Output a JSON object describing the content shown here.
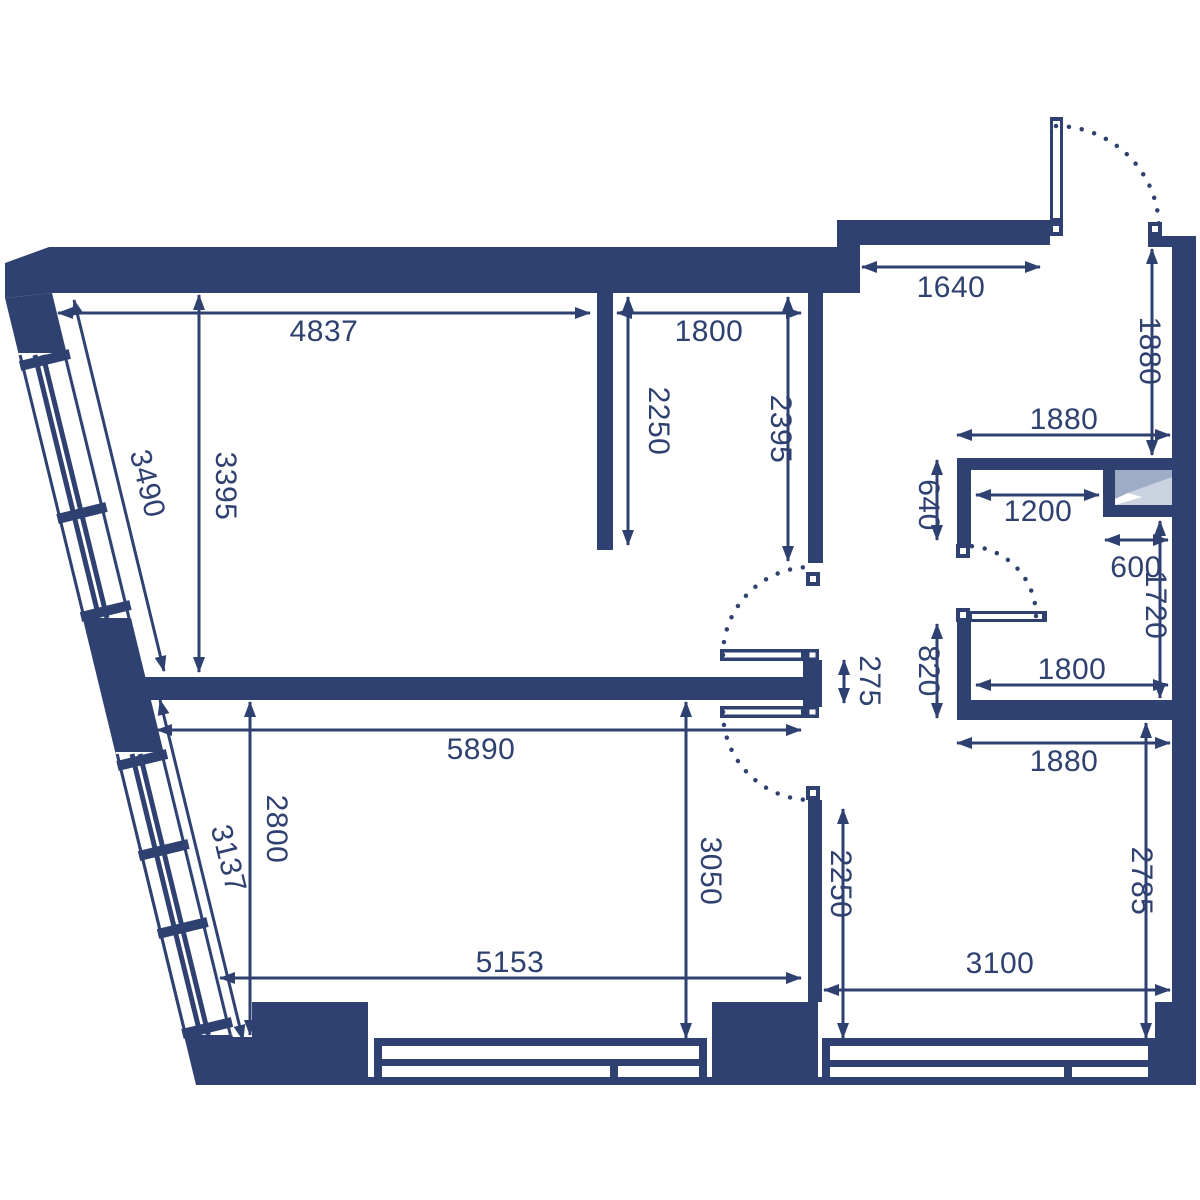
{
  "title": "Apartment floor plan",
  "colors": {
    "wall": "#2f4170",
    "background": "#ffffff",
    "shaft_light": "#cbd3e1",
    "shaft_dark": "#9facc6"
  },
  "dims": {
    "living_room_width": "4837",
    "upper_mid_room_width": "1800",
    "left_partition_length": "2250",
    "right_partition_length": "2395",
    "entry_wall_width": "1640",
    "entry_side_height": "1880",
    "bath_outer_width": "1880",
    "bath_wall_upper": "640",
    "bath_inner_top_width": "1200",
    "shaft_width": "600",
    "bath_inner_right_height": "1720",
    "bath_wall_lower": "820",
    "bath_inner_bottom_width": "1800",
    "below_bath_width": "1880",
    "kitchen_right_height": "2785",
    "kitchen_width": "3100",
    "kitchen_left_height": "2250",
    "lower_room_mid_height": "3050",
    "lower_room_left_height": "2800",
    "hall_span_width": "5890",
    "bay_window_upper_length": "3490",
    "living_room_height": "3395",
    "bay_window_lower_length": "3137",
    "lower_room_width": "5153",
    "door_stub_width": "275"
  }
}
